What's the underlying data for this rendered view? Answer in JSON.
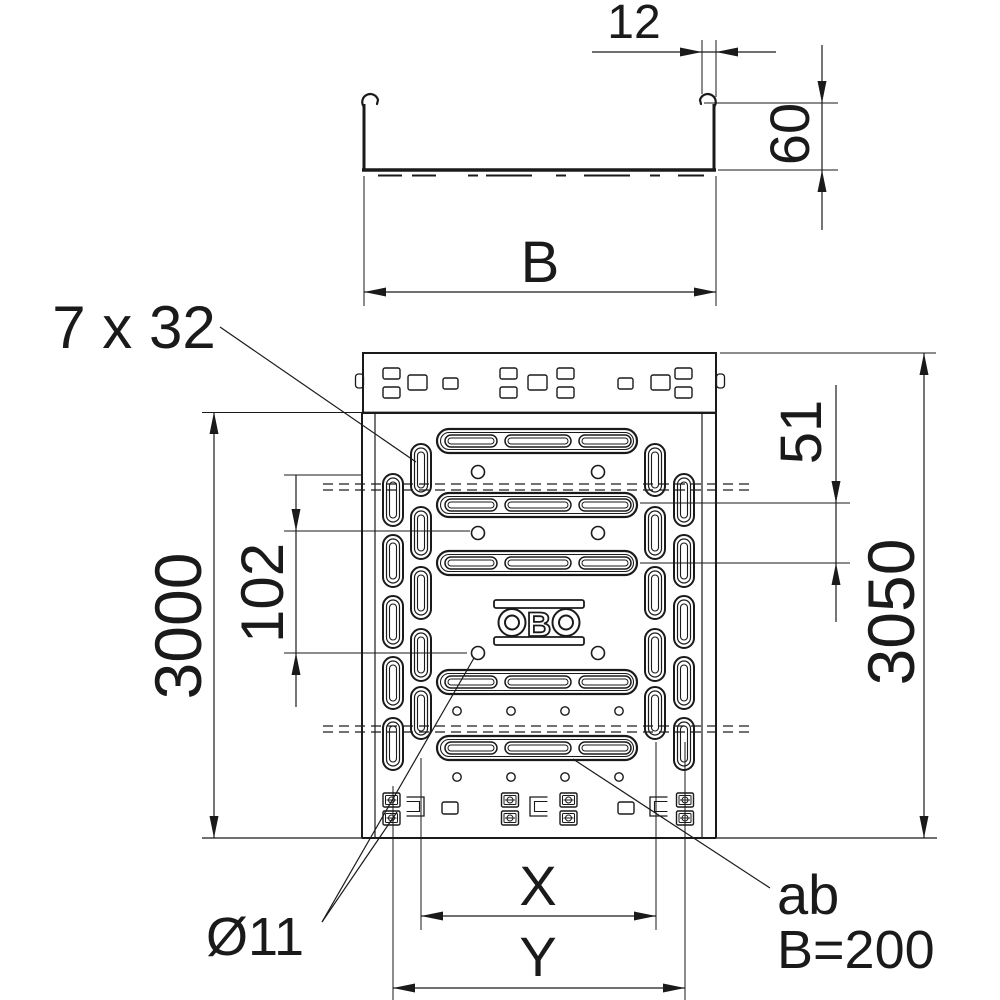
{
  "drawing": {
    "section": {
      "width_label": "12",
      "height_label": "60",
      "b_label": "B"
    },
    "plan": {
      "slot_size_label": "7 x 32",
      "length_label": "3000",
      "hole_spacing_label": "102",
      "slot_spacing_label": "51",
      "total_length_label": "3050",
      "hole_diameter_label": "Ø11",
      "x_label": "X",
      "y_label": "Y",
      "note_line1": "ab",
      "note_line2": "B=200"
    },
    "logo": {
      "text": "OBO",
      "middle_letter": "B"
    },
    "colors": {
      "ink": "#1a1a1a",
      "paper": "#ffffff"
    }
  }
}
